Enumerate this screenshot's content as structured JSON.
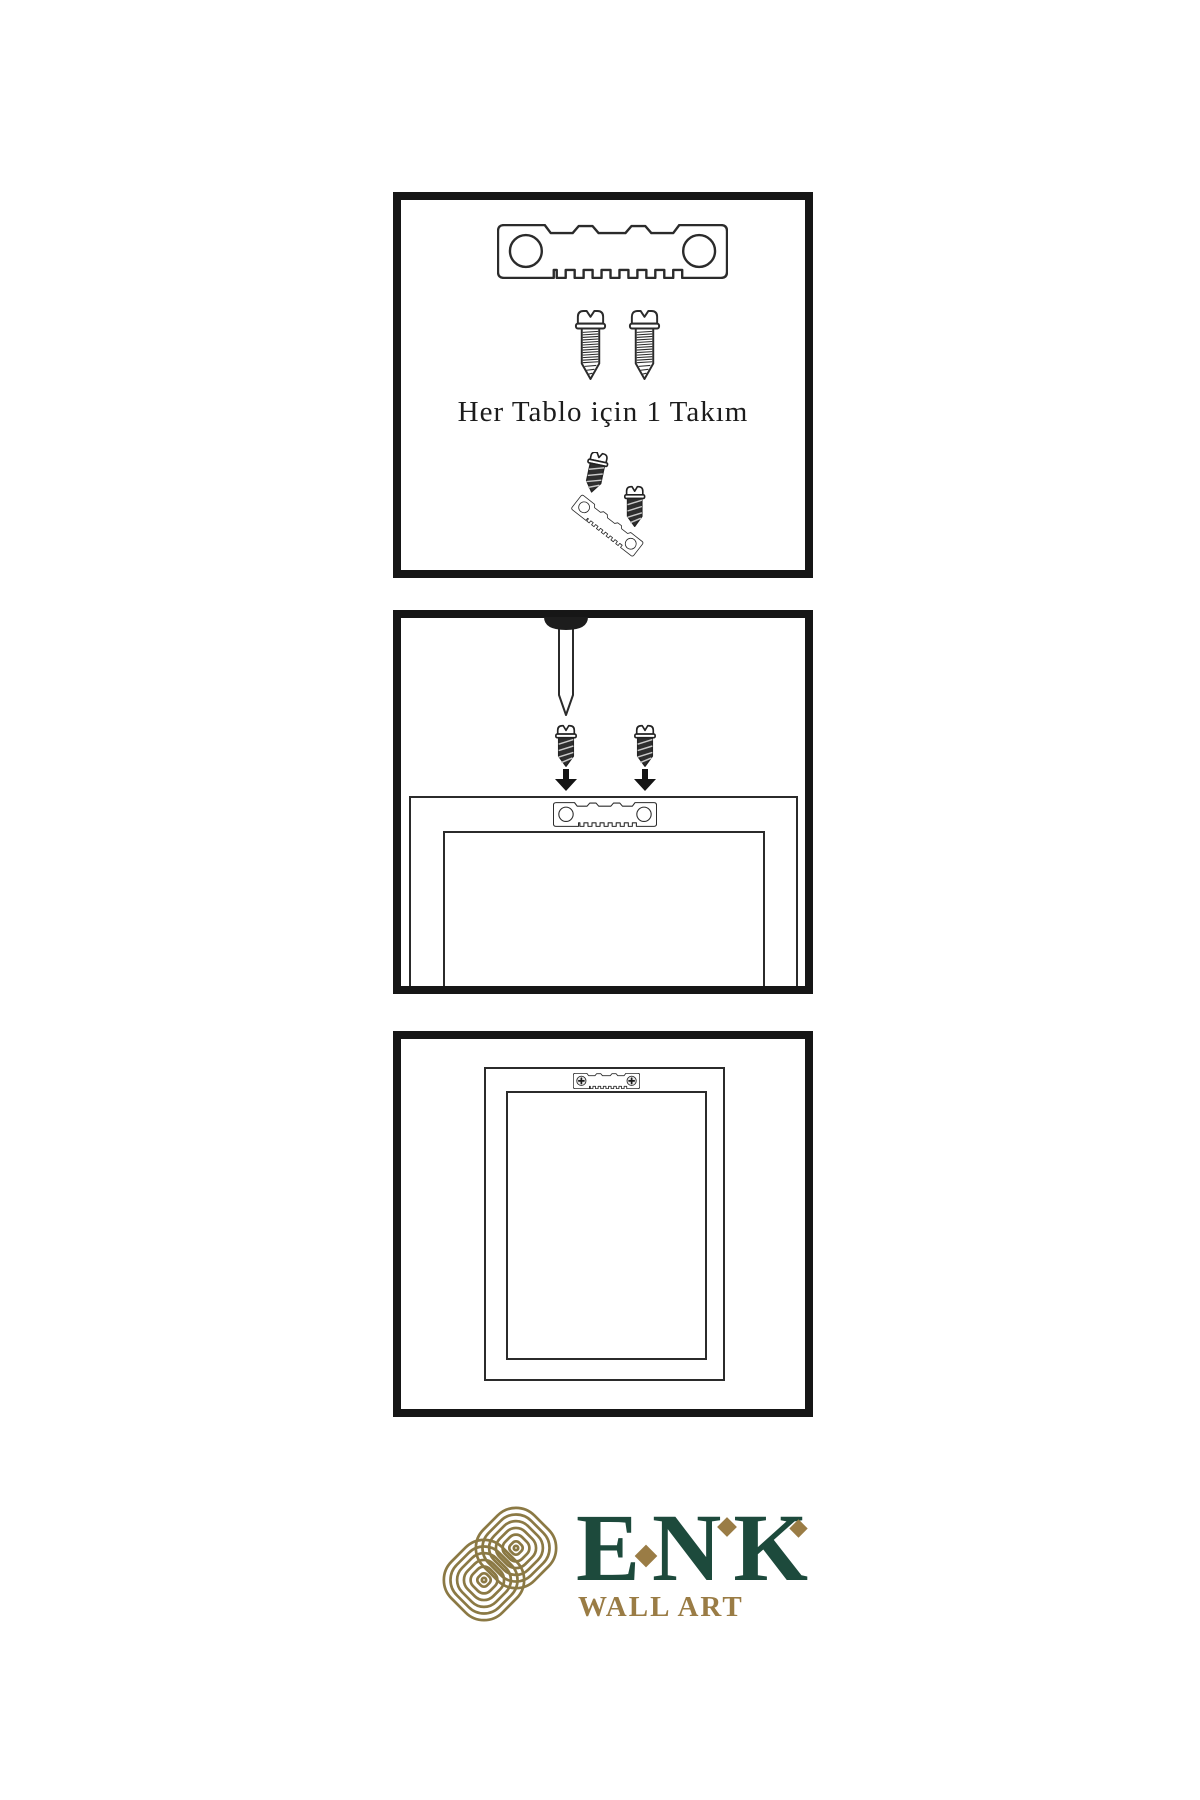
{
  "document": {
    "kind": "wall-art hanging instruction sheet",
    "background": "#ffffff"
  },
  "colors": {
    "panel_border": "#161616",
    "line": "#2b2b2b",
    "screw_dark_fill": "#2e2e2e",
    "brand_green": "#1d4a3c",
    "brand_gold": "#9a7c45",
    "knot_gold": "#8b7944"
  },
  "panels": {
    "step1": {
      "caption": "Her Tablo için 1 Takım",
      "icons": [
        "sawtooth-hanger-icon",
        "screw-icon",
        "screw-icon",
        "mounting-screw-icon",
        "angled-hanger-icon"
      ]
    },
    "step2": {
      "icons": [
        "wall-nail-icon",
        "dark-screw-icon",
        "dark-screw-icon",
        "down-arrow-icon",
        "down-arrow-icon",
        "sawtooth-hanger-icon",
        "picture-frame"
      ]
    },
    "step3": {
      "icons": [
        "mounted-hanger-icon",
        "picture-frame"
      ]
    }
  },
  "brand": {
    "name": "ENK",
    "letters": [
      "E",
      "N",
      "K"
    ],
    "tagline": "WALL ART"
  }
}
